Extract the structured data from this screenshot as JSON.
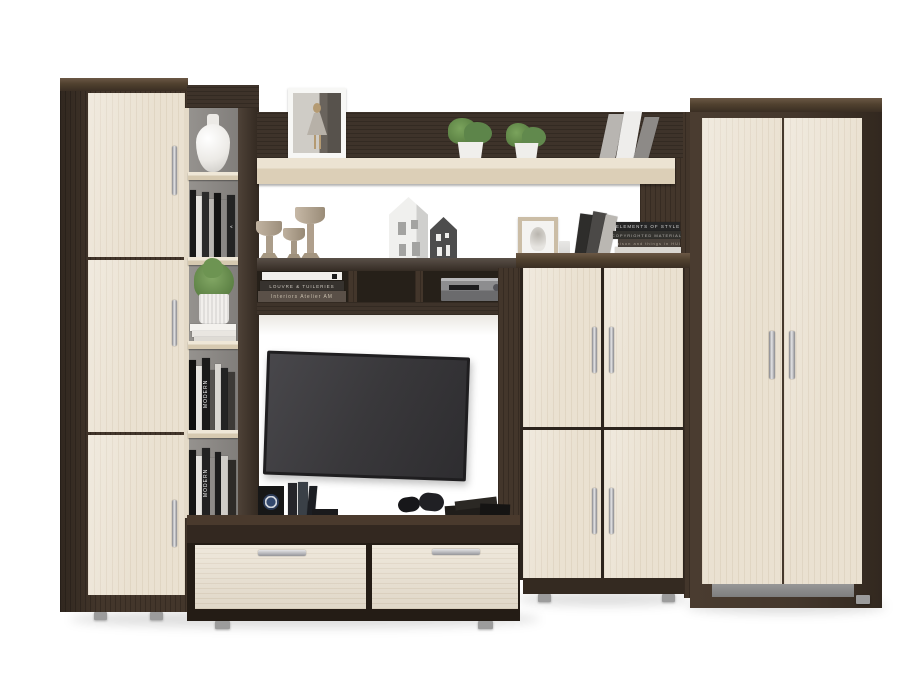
{
  "image": {
    "type": "furniture product photo",
    "subject": "Living-room wall unit in wenge and light oak with TV zone, wardrobe, cabinets and open shelves",
    "background_color": "#ffffff"
  },
  "palette": {
    "wenge": "#43362b",
    "wenge_dark": "#261f18",
    "wenge_top": "#5e4c3b",
    "oak_light": "#eae1d1",
    "shelf_back_gray": "#8f8c89",
    "tv_screen": "#3a393b",
    "plinth_gray": "#8d8d8d",
    "handle_silver": "#d6d6d8",
    "plant_green": "#689050",
    "candle_beige": "#b2a491",
    "house_white": "#e9e9e7",
    "house_dark": "#4d4d4d"
  },
  "units": {
    "left_cabinet": {
      "label": "three-door tall cabinet"
    },
    "shelf_column": {
      "label": "open shelving column"
    },
    "top_shelf": {
      "label": "long wall shelf"
    },
    "bridge_shelf": {
      "label": "open media bridge shelf"
    },
    "tv_stand": {
      "label": "two-drawer TV stand"
    },
    "middle_cabinet": {
      "label": "four-door cabinet"
    },
    "wardrobe": {
      "label": "two-door wardrobe"
    }
  },
  "decor": {
    "vase": "white ceramic vase",
    "photo_frame": "white framed street photo",
    "shelf_plants": "two potted green plants",
    "succulent": "succulent in ribbed white pot",
    "candlesticks": "three beige candle holders",
    "houses": "white and grey house figurines",
    "receiver": "silver hi-fi receiver",
    "tv": "black flat-screen TV",
    "controllers": "two game controllers",
    "speaker": "black box with round emblem",
    "sketch_frame": "beige framed sketch",
    "glass": "small glass"
  },
  "book_spines": {
    "modern": "MODERN",
    "elements": "ELEMENTS OF STYLE",
    "copyrighted": "COPYRIGHTED MATERIAL",
    "maison": "Maison and things in HULL",
    "louvre": "LOUVRE & TUILERIES",
    "interiors": "Interiors Atelier AM",
    "a_mark": "A"
  }
}
